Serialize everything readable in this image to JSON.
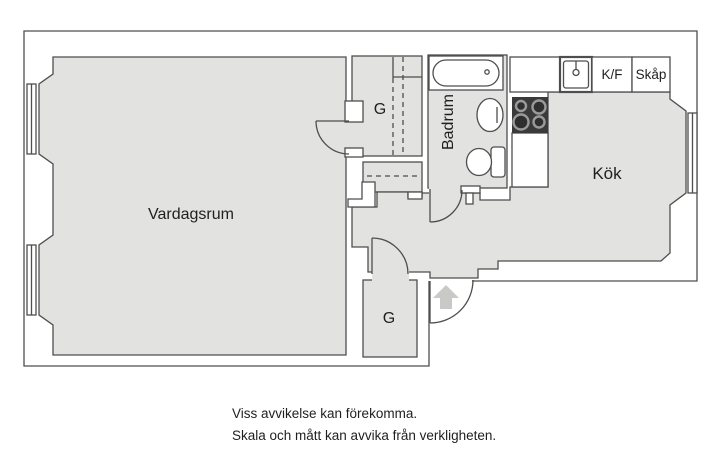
{
  "plan": {
    "rooms": {
      "living_room": "Vardagsrum",
      "bathroom": "Badrum",
      "kitchen": "Kök",
      "closet_upper": "G",
      "closet_lower": "G"
    },
    "units": {
      "fridge_freezer": "K/F",
      "cabinet": "Skåp"
    },
    "colors": {
      "floor": "#e2e2e1",
      "wall": "#4e4e4e",
      "white": "#ffffff",
      "stove_body": "#3a3a3a",
      "burner_ring": "#9a9a9a",
      "burner_center": "#2f2f2f",
      "arrow": "#c9c9c8",
      "text": "#1f1f1f"
    }
  },
  "disclaimer": {
    "line1": "Viss avvikelse kan förekomma.",
    "line2": "Skala och mått kan avvika från verkligheten."
  }
}
